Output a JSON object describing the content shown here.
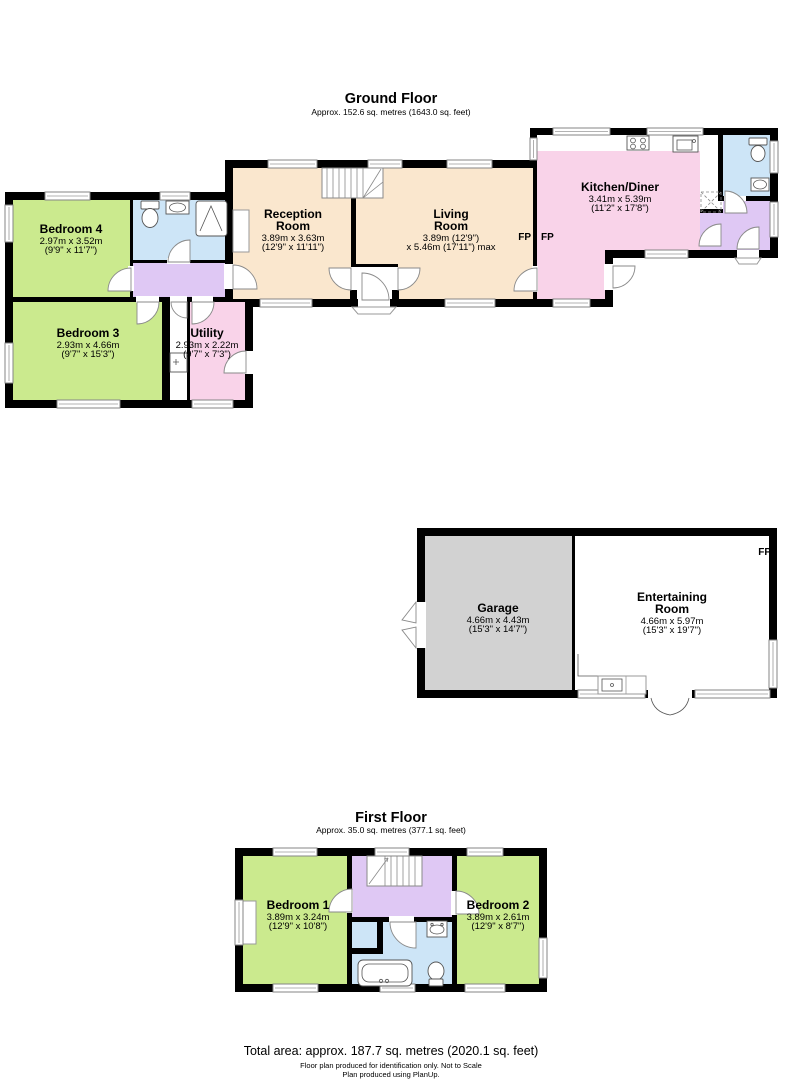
{
  "ground_floor": {
    "title": "Ground Floor",
    "subtitle": "Approx. 152.6 sq. metres (1643.0 sq. feet)",
    "fireplace_label": "FP",
    "rooms": {
      "bedroom4": {
        "name": "Bedroom 4",
        "dim_m": "2.97m x 3.52m",
        "dim_ft": "(9'9\" x 11'7\")"
      },
      "bedroom3": {
        "name": "Bedroom 3",
        "dim_m": "2.93m x 4.66m",
        "dim_ft": "(9'7\" x 15'3\")"
      },
      "utility": {
        "name": "Utility",
        "dim_m": "2.93m x 2.22m",
        "dim_ft": "(9'7\" x 7'3\")"
      },
      "reception": {
        "name1": "Reception",
        "name2": "Room",
        "dim_m": "3.89m x 3.63m",
        "dim_ft": "(12'9\" x 11'11\")"
      },
      "living": {
        "name1": "Living",
        "name2": "Room",
        "dim_m": "3.89m (12'9\")",
        "dim_ft": "x 5.46m (17'11\") max"
      },
      "kitchen": {
        "name": "Kitchen/Diner",
        "dim_m": "3.41m x 5.39m",
        "dim_ft": "(11'2\" x 17'8\")"
      }
    }
  },
  "outbuilding": {
    "fireplace_label": "FP",
    "rooms": {
      "garage": {
        "name": "Garage",
        "dim_m": "4.66m x 4.43m",
        "dim_ft": "(15'3\" x 14'7\")"
      },
      "entertaining": {
        "name1": "Entertaining",
        "name2": "Room",
        "dim_m": "4.66m x 5.97m",
        "dim_ft": "(15'3\" x 19'7\")"
      }
    }
  },
  "first_floor": {
    "title": "First Floor",
    "subtitle": "Approx. 35.0 sq. metres (377.1 sq. feet)",
    "rooms": {
      "bedroom1": {
        "name": "Bedroom 1",
        "dim_m": "3.89m x 3.24m",
        "dim_ft": "(12'9\" x 10'8\")"
      },
      "bedroom2": {
        "name": "Bedroom 2",
        "dim_m": "3.89m x 2.61m",
        "dim_ft": "(12'9\" x 8'7\")"
      }
    }
  },
  "footer": {
    "total_area": "Total area: approx. 187.7 sq. metres (2020.1 sq. feet)",
    "disclaimer": "Floor plan produced for identification only.  Not to Scale",
    "credit": "Plan produced using PlanUp."
  },
  "colors": {
    "wall": "#000000",
    "bedroom_green": "#cbea8e",
    "bathroom_blue": "#cde5f7",
    "hall_purple": "#dfc8f4",
    "pink": "#f9d3e9",
    "beige": "#fae7ce",
    "garage_gray": "#d2d2d2"
  }
}
